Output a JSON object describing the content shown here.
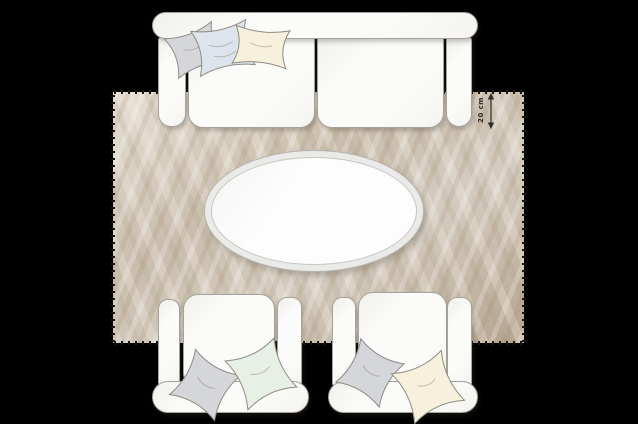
{
  "scene": {
    "annotation": {
      "label": "20 cm"
    },
    "furniture": {
      "sofa": {
        "id": "sofa",
        "pillows": [
          "gray",
          "light-blue",
          "cream"
        ]
      },
      "rug": {
        "id": "rug",
        "edge": "fringed"
      },
      "coffee_table": {
        "id": "coffee-table",
        "shape": "oval"
      },
      "armchair_left": {
        "id": "armchair-left",
        "pillows": [
          "gray",
          "pale-green"
        ]
      },
      "armchair_right": {
        "id": "armchair-right",
        "pillows": [
          "gray",
          "cream"
        ]
      }
    },
    "colors": {
      "background": "#000000",
      "rug-base": "#c9bdac",
      "rug-light": "#e7e0d4",
      "rug-dark": "#b5a48d",
      "fringe": "#1a1712",
      "furniture-fill": "#fbfbf9",
      "furniture-outline": "#a5a29b",
      "table-ring": "#eaeae8",
      "table-top": "#fdfdfd",
      "pillow-gray": "#d5d6da",
      "pillow-blue": "#dee4eb",
      "pillow-cream": "#f6f0dd",
      "pillow-green": "#e8efe5",
      "annotation-ink": "#2c2c28"
    }
  }
}
